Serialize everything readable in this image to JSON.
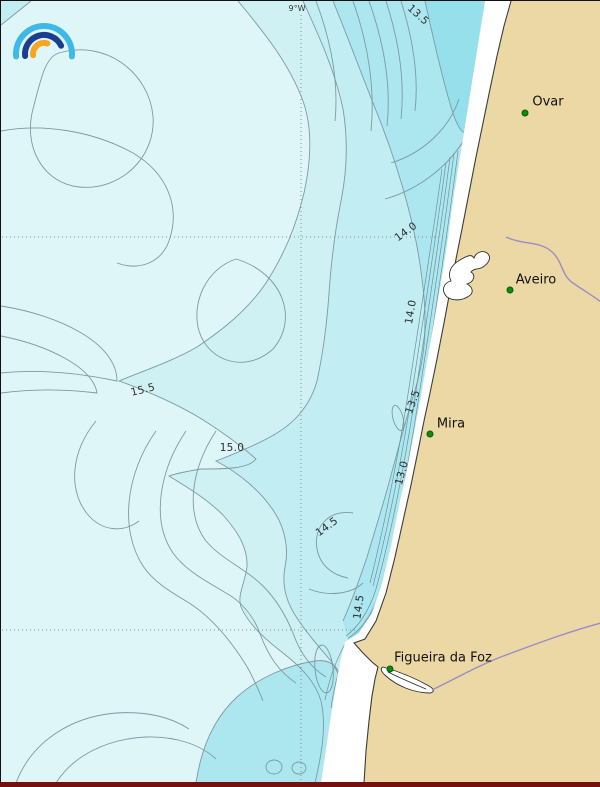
{
  "map": {
    "meridian_label": "9°W",
    "towns": [
      {
        "name": "Ovar",
        "dot_x": 524,
        "dot_y": 112,
        "label_x": 547,
        "label_y": 101
      },
      {
        "name": "Aveiro",
        "dot_x": 509,
        "dot_y": 289,
        "label_x": 535,
        "label_y": 279
      },
      {
        "name": "Mira",
        "dot_x": 429,
        "dot_y": 433,
        "label_x": 450,
        "label_y": 423
      },
      {
        "name": "Figueira da Foz",
        "dot_x": 389,
        "dot_y": 668,
        "label_x": 442,
        "label_y": 657
      }
    ],
    "contour_labels": [
      {
        "text": "13.5",
        "x": 417,
        "y": 14,
        "rot": 42
      },
      {
        "text": "14.0",
        "x": 405,
        "y": 231,
        "rot": -36
      },
      {
        "text": "14.0",
        "x": 410,
        "y": 311,
        "rot": -80
      },
      {
        "text": "13.5",
        "x": 412,
        "y": 401,
        "rot": -70
      },
      {
        "text": "13.0",
        "x": 401,
        "y": 472,
        "rot": -75
      },
      {
        "text": "15.5",
        "x": 142,
        "y": 389,
        "rot": -14
      },
      {
        "text": "15.0",
        "x": 231,
        "y": 447,
        "rot": 0
      },
      {
        "text": "14.5",
        "x": 326,
        "y": 526,
        "rot": -36
      },
      {
        "text": "14.5",
        "x": 358,
        "y": 606,
        "rot": -82
      }
    ],
    "colors": {
      "ocean_base": "#def6f8",
      "band2": "#d0f1f4",
      "band3": "#c2edf2",
      "band4": "#ace7f0",
      "band4_core": "#96e0ec",
      "coastal_stripe": "#8cdcea",
      "contour_line": "#7d9aa2",
      "dense_line": "#6d9099",
      "land": "#ecd8a5",
      "beach": "#ffffff",
      "coastline": "#3c3c3c",
      "river": "#9a8dc7",
      "lagoon_outline": "#2f2f2f",
      "town_dot": "#0a8f0a",
      "grid": "#8a8a8a",
      "frame": "#111111",
      "bottom_strip": "#76100f",
      "logo_outer": "#3eb8e8",
      "logo_middle": "#1b3e8e",
      "logo_inner": "#f7a61e"
    }
  }
}
